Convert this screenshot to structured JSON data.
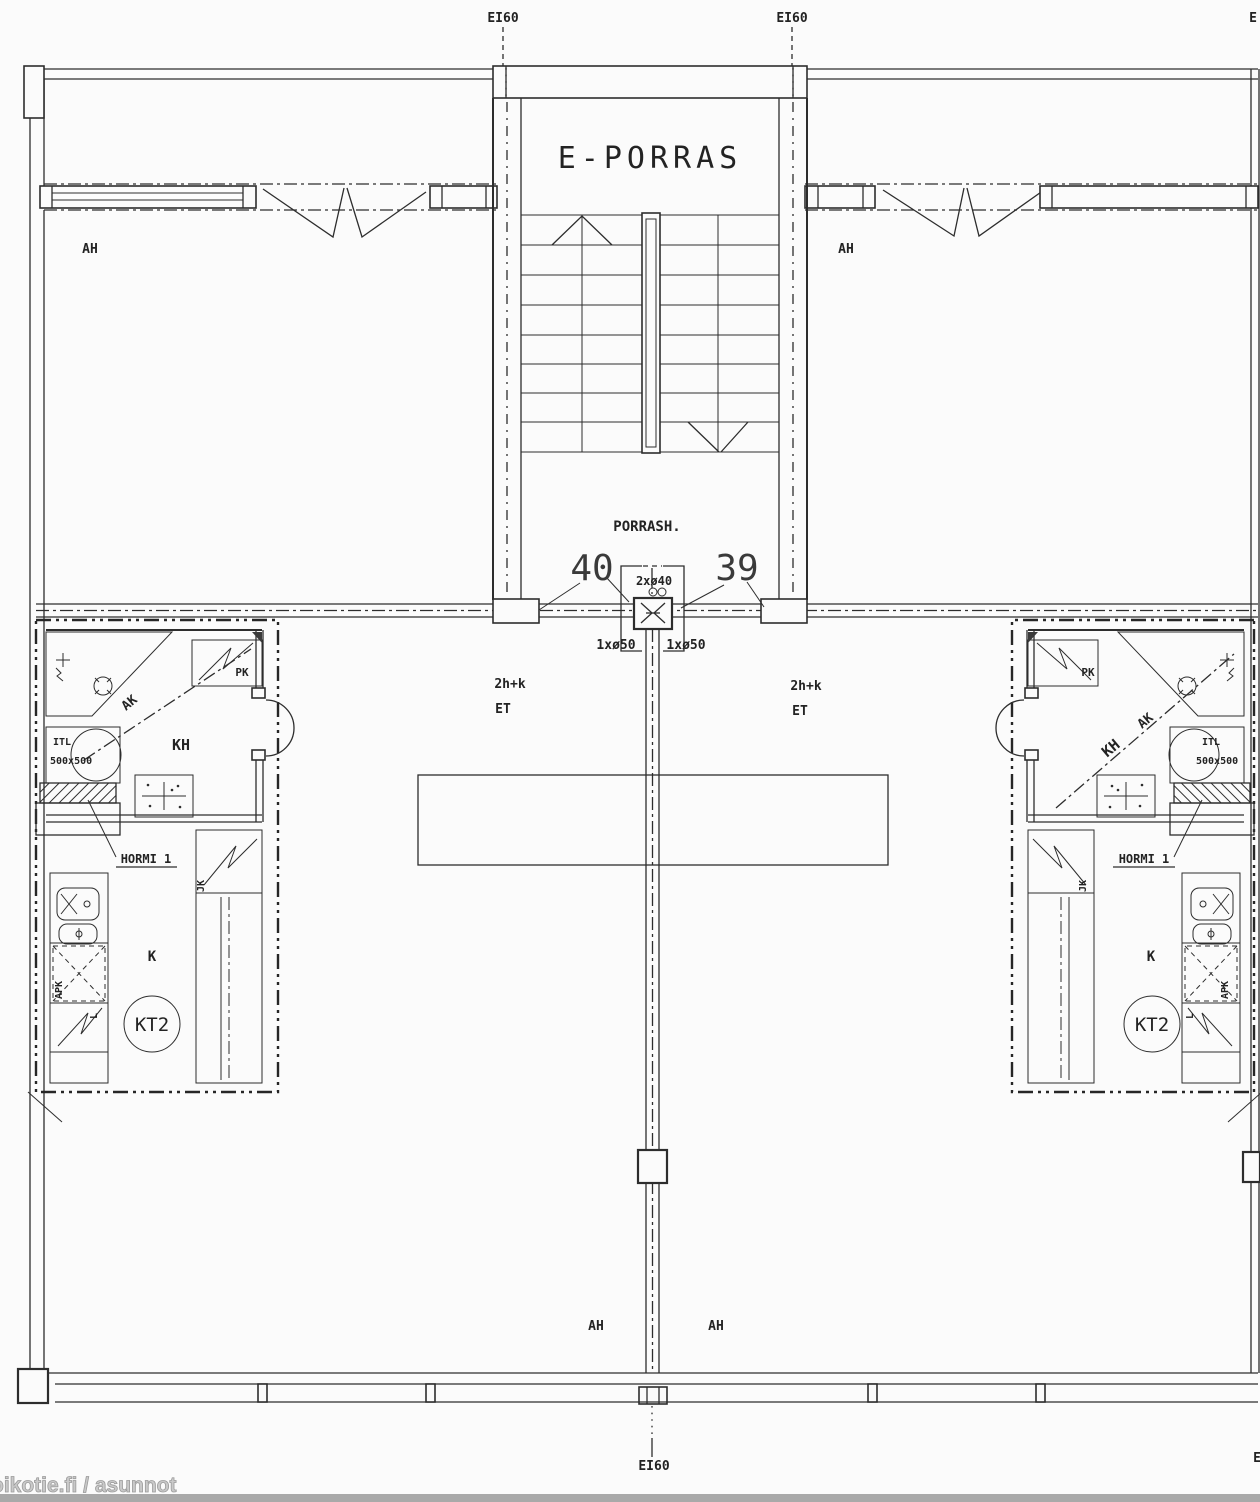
{
  "plan_labels": {
    "fire_top_left": "EI60",
    "fire_top_right": "EI60",
    "fire_top_edge": "E",
    "fire_bottom": "EI60",
    "fire_bottom_edge": "E",
    "balcony_top_left": "AH",
    "balcony_top_right": "AH",
    "balcony_bottom_left": "AH",
    "balcony_bottom_right": "AH"
  },
  "stairwell": {
    "name": "E-PORRAS",
    "hall_abbr": "PORRASH.",
    "pipe_top": "2xø40",
    "pipe_left": "1xø50",
    "pipe_right": "1xø50"
  },
  "apartments": {
    "left": {
      "number": "40",
      "type": "2h+k",
      "entry": "ET",
      "bathroom": "KH",
      "closet": "AK",
      "washing_machine": "PK",
      "vent_unit": "ITL",
      "vent_unit_size": "500x500",
      "duct": "HORMI 1",
      "fridge": "JK",
      "dishwasher": "APK",
      "stove": "L",
      "kitchen": "K",
      "kitchen_type": "KT2"
    },
    "right": {
      "number": "39",
      "type": "2h+k",
      "entry": "ET",
      "bathroom": "KH",
      "closet": "AK",
      "washing_machine": "PK",
      "vent_unit": "ITL",
      "vent_unit_size": "500x500",
      "duct": "HORMI 1",
      "fridge": "JK",
      "dishwasher": "APK",
      "stove": "L",
      "kitchen": "K",
      "kitchen_type": "KT2"
    }
  },
  "watermark": "oikotie.fi / asunnot"
}
